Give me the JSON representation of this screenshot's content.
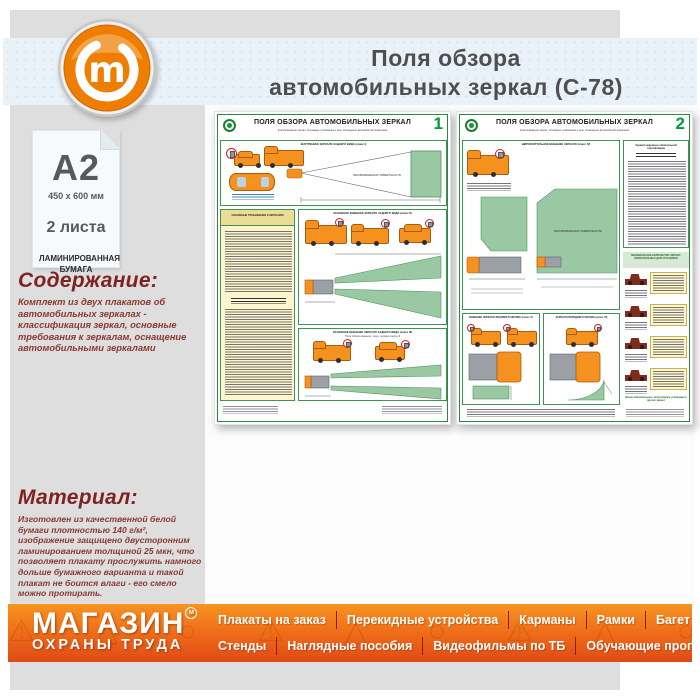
{
  "header": {
    "title_line1": "Поля обзора",
    "title_line2": "автомобильных зеркал (С-78)"
  },
  "sidebar": {
    "format": "А2",
    "size": "450 х 600 мм",
    "sheets": "2 листа",
    "paper": "ЛАМИНИРОВАННАЯ БУМАГА",
    "content_heading": "Содержание:",
    "content_text": "Комплект из двух плакатов об автомобильных зеркалах - классификация зеркал, основные требования к зеркалам, оснащение автомобильными зеркалами",
    "material_heading": "Материал:",
    "material_text": "Изготовлен из качественной белой бумаги плотностью 140 г/м², изображение защищено двусторонним ламинированием толщиной 25 мкн, что позволяет плакату прослужить намного дольше бумажного варианта и такой плакат не боится влаги - его смело можно протирать."
  },
  "posters": {
    "title": "ПОЛЯ ОБЗОРА АВТОМОБИЛЬНЫХ ЗЕРКАЛ",
    "subtitle": "Классификация зеркал. Основные требования к ним. Оснащение автомобилей зеркалами",
    "surface": "ОБОЗРЕВАЕМАЯ ПОВЕРХНОСТЬ",
    "p1": {
      "number": "1",
      "class1": "ВНУТРЕННЕЕ ЗЕРКАЛО ЗАДНЕГО ВИДА (класс I)",
      "req": "ОСНОВНЫЕ ТРЕБОВАНИЯ К ЗЕРКАЛАМ",
      "class2": "ОСНОВНОЕ ВНЕШНЕЕ ЗЕРКАЛО ЗАДНЕГО ВИДА (класс II)",
      "class3": "ОСНОВНОЕ ВНЕШНЕЕ ЗЕРКАЛО ЗАДНЕГО ВИДА (класс III)",
      "class3_note": "Поля обзора меньше, чем у зеркал класса II"
    },
    "p2": {
      "number": "2",
      "class4": "ШИРОКОУГОЛЬНОЕ ВНЕШНЕЕ ЗЕРКАЛО (класс IV)",
      "class5": "ВНЕШНЕЕ ЗЕРКАЛО БОКОВОГО ОБЗОРА (класс V)",
      "class6": "ЗЕРКАЛО ПЕРЕДНЕГО ОБЗОРА (класс VI)",
      "cert_heading": "Зеркала наружные обязательной сертификации",
      "min_mirrors": "МИНИМАЛЬНОЕ КОЛИЧЕСТВО ЗЕРКАЛ, ОБЯЗАТЕЛЬНЫХ ДЛЯ УСТАНОВКИ",
      "note": "Кроме обязательных, допускается установка и других зеркал"
    }
  },
  "footer": {
    "logo_line1": "МАГАЗИН",
    "logo_line2": "ОХРАНЫ ТРУДА",
    "trademark": "м",
    "menu_row1": [
      "Плакаты на заказ",
      "Перекидные устройства",
      "Карманы",
      "Рамки",
      "Багет"
    ],
    "menu_row2": [
      "Стенды",
      "Наглядные пособия",
      "Видеофильмы по ТБ",
      "Обучающие программы"
    ]
  },
  "icons": {
    "logo_glyph": "m",
    "watermark_signs": "⚠ △ ○ ⚠ △ ○ ⚠ △ ○ ⚠ △ ○ ⚠"
  },
  "colors": {
    "accent_orange": "#f07d17",
    "footer_gradient_top": "#f79420",
    "footer_gradient_bottom": "#e04a15",
    "maroon_text": "#7d2422",
    "poster_green": "#1e7c36",
    "field_green": "#9ac8a2",
    "blue_band": "#e9f2f8",
    "panel_gray": "#dedede"
  }
}
